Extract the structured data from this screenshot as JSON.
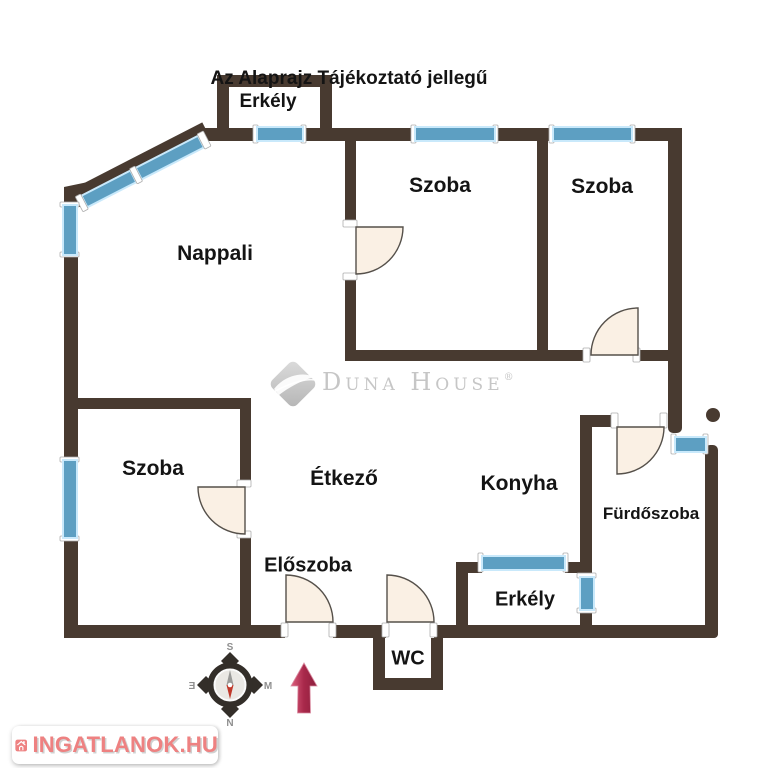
{
  "title": "Az Alaprajz Tájékoztató jellegű",
  "rooms": {
    "erkely_top": "Erkély",
    "szoba_mid": "Szoba",
    "szoba_right": "Szoba",
    "nappali": "Nappali",
    "szoba_left": "Szoba",
    "etkezo": "Étkező",
    "konyha": "Konyha",
    "furdoszoba": "Fürdőszoba",
    "eloszoba": "Előszoba",
    "erkely_bottom": "Erkély",
    "wc": "WC"
  },
  "watermark": {
    "brand": "Duna House",
    "registered": "®"
  },
  "compass": {
    "top": "S",
    "bottom": "N",
    "left": "Ǝ",
    "right": "M"
  },
  "footer_logo": {
    "text": "INGATLANOK.HU"
  },
  "colors": {
    "wall": "#483a30",
    "window": "#5d9fc2",
    "window_glow": "#c9e9fb",
    "door_fill": "#faf0e4",
    "compass_needle_red": "#c0392b",
    "arrow_red": "#a8284a",
    "logo_red": "#ee8181",
    "watermark_gray": "#c6c6c6"
  }
}
